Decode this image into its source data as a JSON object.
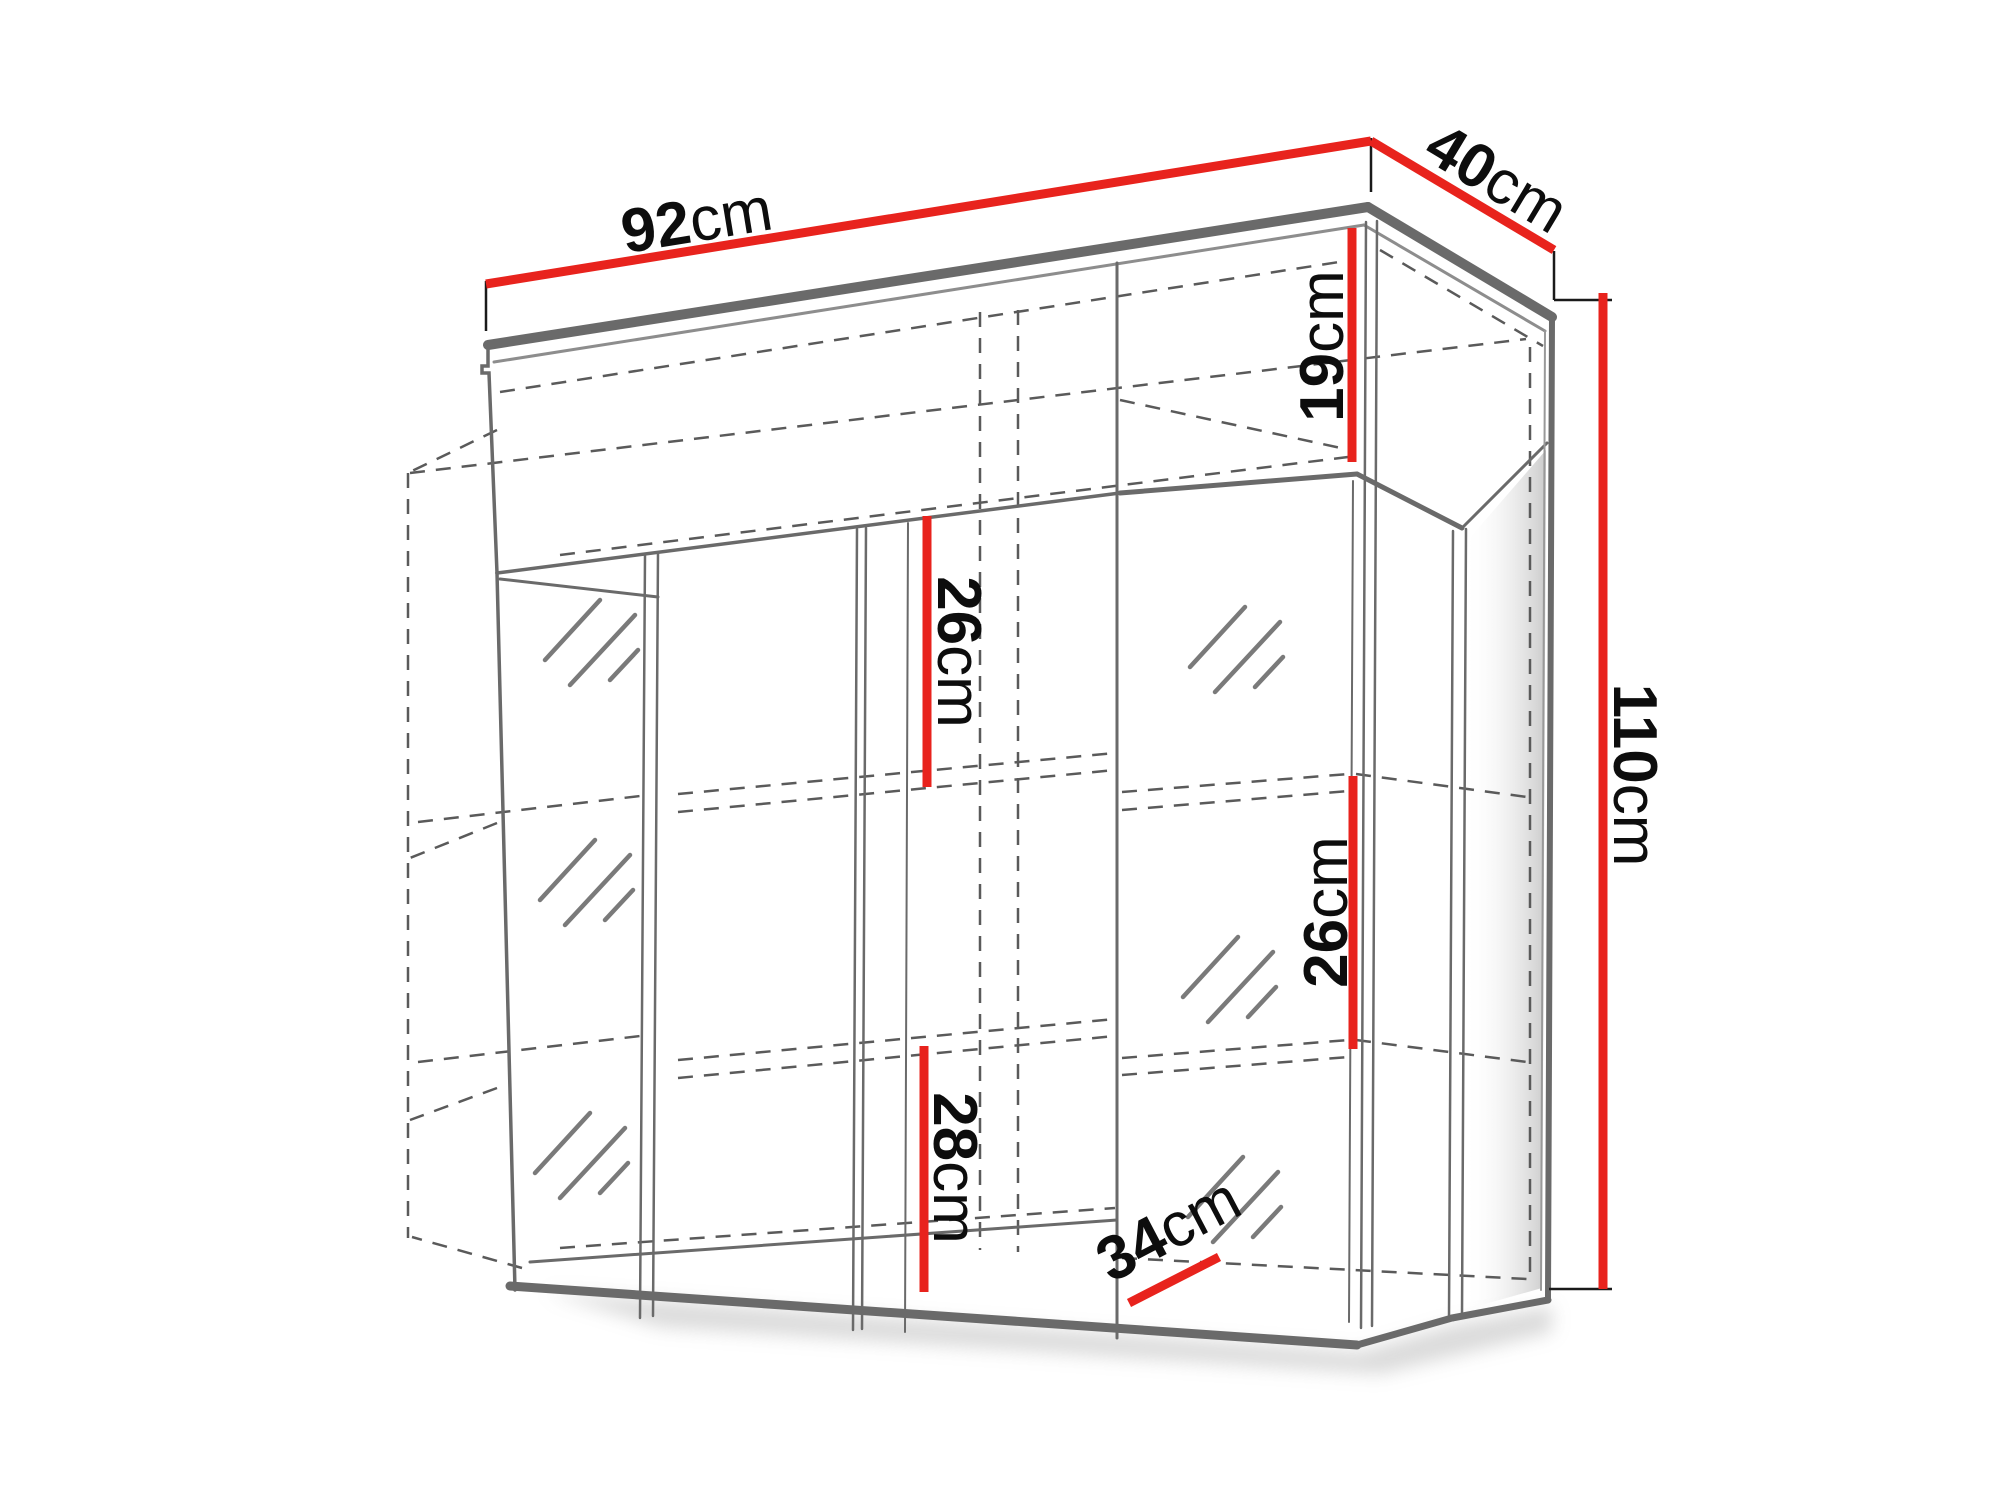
{
  "diagram": {
    "type": "furniture-dimension-diagram",
    "subject": "wall-mounted display cabinet (vitrine) perspective line drawing",
    "colors": {
      "dimension_line": "#e8231d",
      "outline": "#6a6a6a",
      "hidden_line": "#5a5a5a",
      "label_text": "#0d0d0d",
      "background": "#ffffff"
    },
    "dimensions": {
      "width": {
        "value": "92",
        "unit": "cm",
        "description": "overall width (top front edge)"
      },
      "depth": {
        "value": "40",
        "unit": "cm",
        "description": "overall depth (top right edge)"
      },
      "height": {
        "value": "110",
        "unit": "cm",
        "description": "overall height (right side)"
      },
      "top_compartment": {
        "value": "19",
        "unit": "cm",
        "description": "top open shelf interior height"
      },
      "upper_middle": {
        "value": "26",
        "unit": "cm",
        "description": "upper middle compartment height"
      },
      "right_compartment": {
        "value": "26",
        "unit": "cm",
        "description": "right compartment shelf height"
      },
      "lower_middle": {
        "value": "28",
        "unit": "cm",
        "description": "lower middle compartment height"
      },
      "interior_depth": {
        "value": "34",
        "unit": "cm",
        "description": "interior shelf depth (bottom)"
      }
    }
  }
}
